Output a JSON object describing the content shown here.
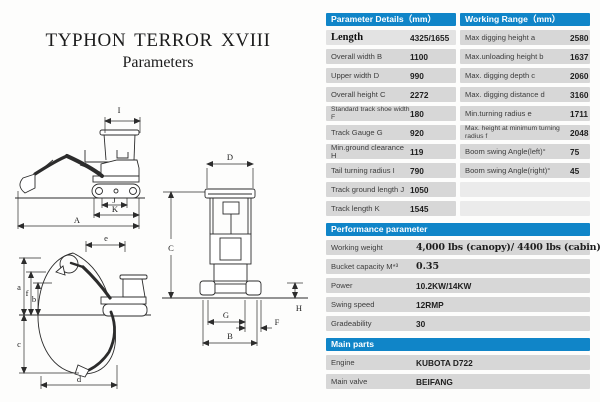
{
  "title": {
    "line1": "TYPHON TERROR XVIII",
    "line2": "Parameters"
  },
  "colors": {
    "header_blue": "#1085c8",
    "row_gray": "#d7d7d7",
    "row_first": "#e3e3e3",
    "row_empty": "#ebebeb",
    "page_bg": "#fdfdfc"
  },
  "param_table": {
    "header": "Parameter Details（mm）",
    "rows": [
      {
        "label": "Length",
        "value": "4325/1655"
      },
      {
        "label": "Overall width B",
        "value": "1100"
      },
      {
        "label": "Upper width D",
        "value": "990"
      },
      {
        "label": "Overall height C",
        "value": "2272"
      },
      {
        "label": "Standard track shoe width F",
        "value": "180"
      },
      {
        "label": "Track Gauge G",
        "value": "920"
      },
      {
        "label": "Min.ground clearance H",
        "value": "119"
      },
      {
        "label": "Tail turning radius I",
        "value": "790"
      },
      {
        "label": "Track ground length J",
        "value": "1050"
      },
      {
        "label": "Track length K",
        "value": "1545"
      }
    ]
  },
  "range_table": {
    "header": "Working Range（mm）",
    "rows": [
      {
        "label": "Max digging height a",
        "value": "2580"
      },
      {
        "label": "Max.unloading height b",
        "value": "1637"
      },
      {
        "label": "Max. digging depth c",
        "value": "2060"
      },
      {
        "label": "Max. digging distance d",
        "value": "3160"
      },
      {
        "label": "Min.turning radius e",
        "value": "1711"
      },
      {
        "label": "Max. height at minimum turning radius f",
        "value": "2048"
      },
      {
        "label": "Boom swing Angle(left)°",
        "value": "75"
      },
      {
        "label": "Boom swing Angle(right)°",
        "value": "45"
      }
    ]
  },
  "performance_table": {
    "header": "Performance parameter",
    "rows": [
      {
        "label": "Working weight",
        "value": "4,000 lbs (canopy)/ 4400 lbs (cabin)"
      },
      {
        "label": "Bucket capacity M*³",
        "value": "0.35"
      },
      {
        "label": "Power",
        "value": "10.2KW/14KW"
      },
      {
        "label": "Swing speed",
        "value": "12RMP"
      },
      {
        "label": "Gradeability",
        "value": "30"
      }
    ]
  },
  "main_parts_table": {
    "header": "Main parts",
    "rows": [
      {
        "label": "Engine",
        "value": "KUBOTA D722"
      },
      {
        "label": "Main valve",
        "value": "BEIFANG"
      }
    ]
  },
  "diagram_labels": {
    "side": {
      "I": "I",
      "J": "J",
      "K": "K",
      "A": "A"
    },
    "range": {
      "e": "e",
      "a": "a",
      "f": "f",
      "b": "b",
      "c": "c",
      "d": "d"
    },
    "front": {
      "D": "D",
      "C": "C",
      "G": "G",
      "B": "B",
      "F": "F",
      "H": "H"
    }
  }
}
